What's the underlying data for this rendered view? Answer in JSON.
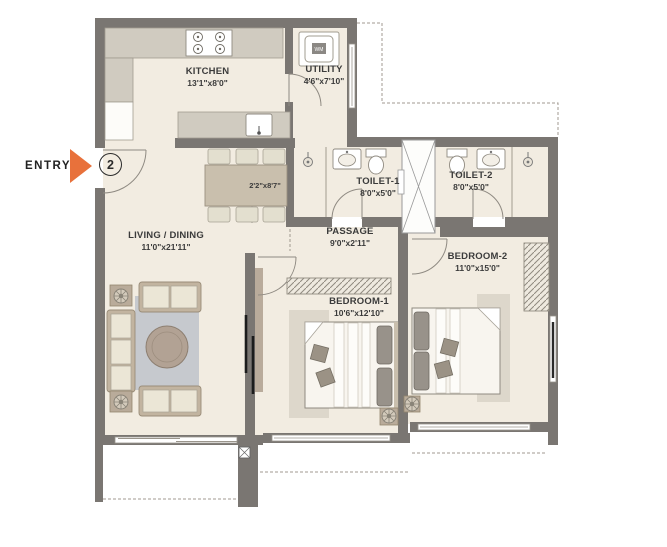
{
  "entry": {
    "label": "ENTRY",
    "door_number": "2"
  },
  "rooms": {
    "kitchen": {
      "name": "KITCHEN",
      "dims": "13'1\"x8'0\""
    },
    "utility": {
      "name": "UTILITY",
      "dims": "4'6\"x7'10\"",
      "washer_label": "WM"
    },
    "living_dining": {
      "name": "LIVING / DINING",
      "dims": "11'0\"x21'11\""
    },
    "passage": {
      "name": "PASSAGE",
      "dims": "9'0\"x2'11\""
    },
    "toilet1": {
      "name": "TOILET-1",
      "dims": "8'0\"x5'0\""
    },
    "toilet2": {
      "name": "TOILET-2",
      "dims": "8'0\"x5'0\""
    },
    "bedroom1": {
      "name": "BEDROOM-1",
      "dims": "10'6\"x12'10\""
    },
    "bedroom2": {
      "name": "BEDROOM-2",
      "dims": "11'0\"x15'0\""
    },
    "dining_niche": {
      "dims": "2'2\"x8'7\""
    }
  },
  "colors": {
    "wall": "#7a7672",
    "floor": "#f2ece1",
    "accent": "#e8713b",
    "furniture": "#c9bfad",
    "rug": "#c6c9ce",
    "text": "#3b3b3b"
  }
}
